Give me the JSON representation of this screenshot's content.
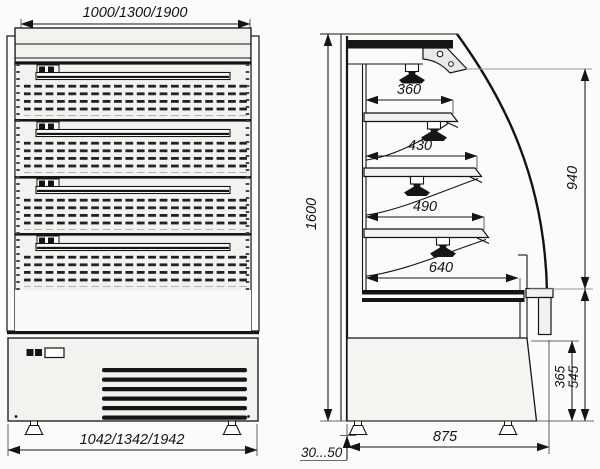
{
  "front_view": {
    "dim_width_top": "1000/1300/1900",
    "dim_width_bottom": "1042/1342/1942"
  },
  "side_view": {
    "dim_overall_height": "1600",
    "dim_glass_height": "940",
    "dim_shelf_depth_1": "360",
    "dim_shelf_depth_2": "430",
    "dim_shelf_depth_3": "490",
    "dim_deck_depth": "640",
    "dim_base_height": "365",
    "dim_lower_front_height": "545",
    "dim_overall_depth": "875",
    "dim_foot_adjust_range": "30...50"
  }
}
